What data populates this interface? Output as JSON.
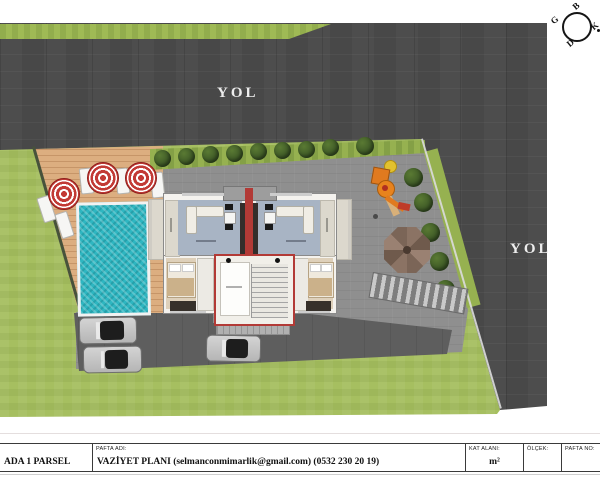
{
  "roads": {
    "top_label": "YOL",
    "right_label": "YOL"
  },
  "compass": {
    "north_label": "K",
    "south_label": "G",
    "east_label": "D",
    "west_label": "B"
  },
  "title_block": {
    "parcel_cell": "ADA 1 PARSEL",
    "sheet_name_header": "PAFTA ADI:",
    "sheet_name_value": "VAZİYET PLANI (selmanconmimarlik@gmail.com) (0532 230 20 19)",
    "floor_area_header": "KAT ALANI:",
    "floor_area_value": "m²",
    "scale_header": "ÖLÇEK:",
    "scale_value": "",
    "sheet_no_header": "PAFTA NO:",
    "sheet_no_value": ""
  },
  "colors": {
    "road": "#4d4d4d",
    "lawn": "#a6bf60",
    "pool_water": "#2eb6c1",
    "deck_wood": "#dcae80",
    "pavement": "#8f8f8f",
    "parking": "#5e5e5e",
    "building_floor": "#a8b4c4",
    "accent_wall_red": "#b23a36",
    "umbrella_red": "#c23a35"
  }
}
